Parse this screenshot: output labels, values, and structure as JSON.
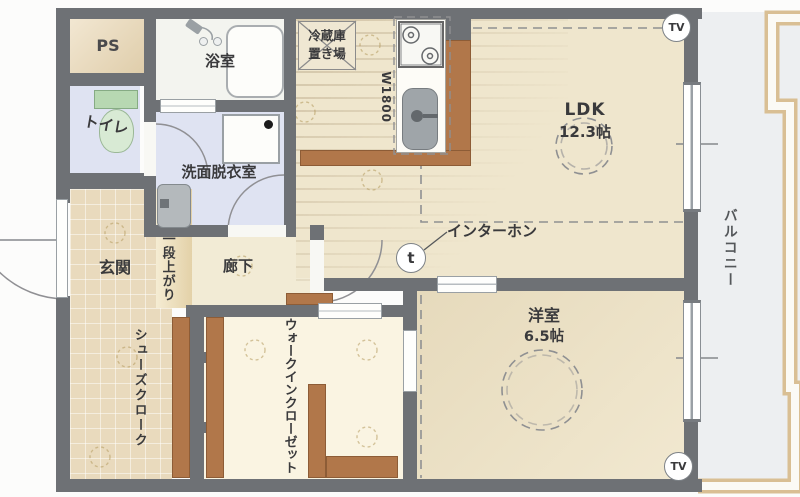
{
  "rooms": {
    "ps": {
      "label": "PS"
    },
    "bathroom": {
      "label": "浴室"
    },
    "toilet": {
      "label": "トイレ"
    },
    "washroom": {
      "label": "洗面脱衣室"
    },
    "entrance": {
      "label": "玄関"
    },
    "shoe_closet": {
      "label": "シューズクローク"
    },
    "step_up": {
      "label": "一段上がり"
    },
    "corridor": {
      "label": "廊下"
    },
    "kitchen": {
      "fridge_line1": "冷蔵庫",
      "fridge_line2": "置き場",
      "width_label": "W1800"
    },
    "ldk": {
      "label": "LDK",
      "size": "12.3帖"
    },
    "western_room": {
      "label": "洋室",
      "size": "6.5帖"
    },
    "walk_in_closet": {
      "label": "ウォークインクローゼット"
    },
    "balcony": {
      "label": "バルコニー"
    }
  },
  "marks": {
    "tv_top": "TV",
    "tv_bottom": "TV",
    "intercom_label": "インターホン",
    "intercom_symbol": "t"
  },
  "colors": {
    "wall": "#6e7175",
    "wood_counter": "#b1774a",
    "tile_floor": "#e9dabd",
    "wet_floor": "#dfe3f2",
    "bath_floor": "#f3f4ef",
    "ldk_floor": "#efe6cd",
    "western_floor": "#eadfc2",
    "closet_floor": "#faf4e2",
    "balcony_floor": "#edeff1",
    "railing": "#d9bf94"
  }
}
